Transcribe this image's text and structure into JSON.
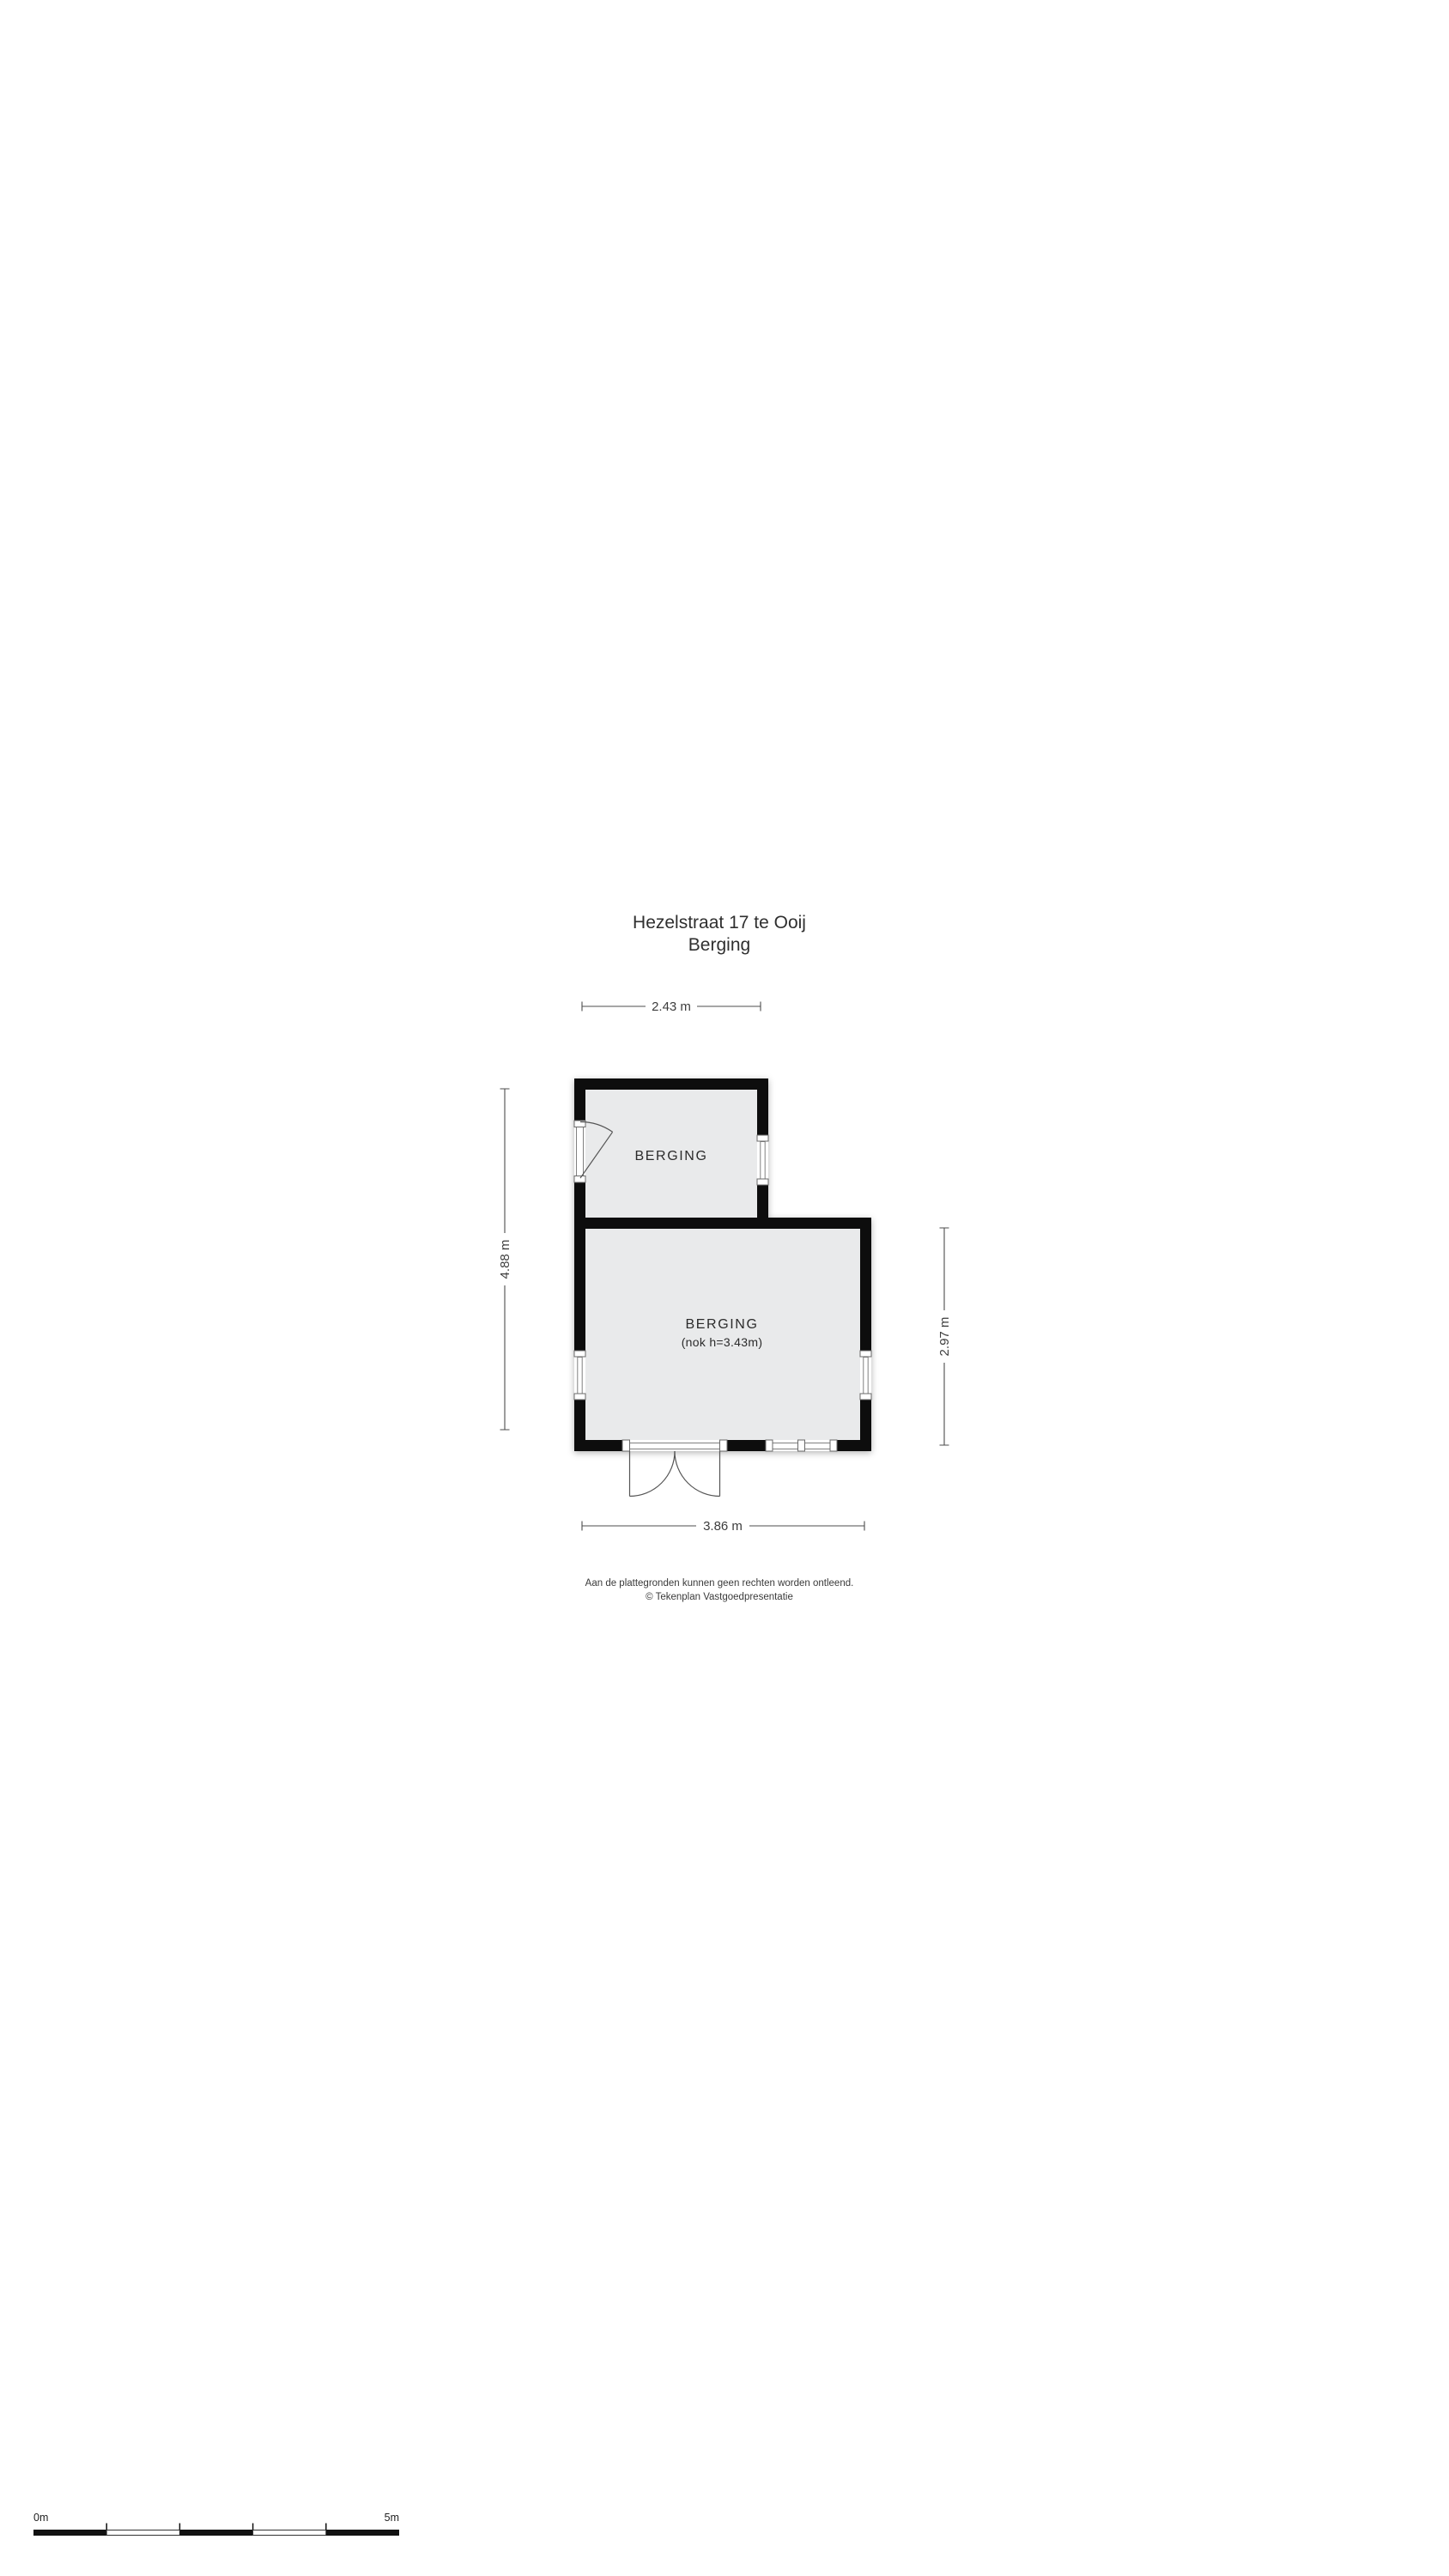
{
  "title": {
    "line1": "Hezelstraat 17 te Ooij",
    "line2": "Berging"
  },
  "plan": {
    "room_top": {
      "label": "BERGING"
    },
    "room_main": {
      "label": "BERGING",
      "sublabel": "(nok h=3.43m)"
    },
    "dimensions": {
      "width_top": "2.43 m",
      "height_left": "4.88 m",
      "height_right": "2.97 m",
      "width_bottom": "3.86 m"
    }
  },
  "footer": {
    "line1": "Aan de plattegronden kunnen geen rechten worden ontleend.",
    "line2": "© Tekenplan Vastgoedpresentatie"
  },
  "scale_bar": {
    "start_label": "0m",
    "end_label": "5m"
  },
  "colors": {
    "wall": "#111111",
    "room_fill": "#e9eaeb",
    "opening": "#ffffff"
  }
}
